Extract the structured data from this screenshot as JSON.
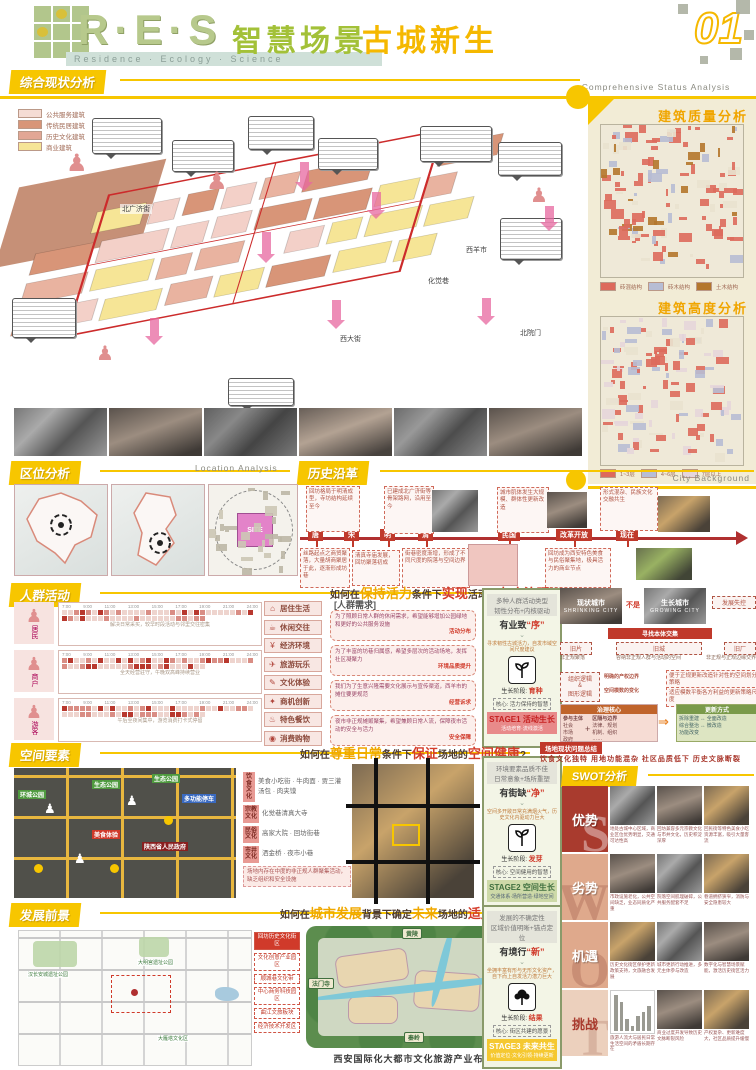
{
  "palette": {
    "accent_yellow": "#f7c600",
    "accent_orange": "#f0a500",
    "brand_green": "#a3c138",
    "deep_red": "#c0392b",
    "cream": "#f2ecd6",
    "swot_dark": "#a93b2e",
    "swot_peach": "#dfa98c"
  },
  "header": {
    "logo": "R·E·S",
    "logo_sub": "Residence · Ecology · Science",
    "title_green": "智慧场景",
    "title_yellow": "古城新生",
    "page_no": "01",
    "section_en": "Comprehensive Status Analysis"
  },
  "status": {
    "title": "综合现状分析",
    "legend": [
      {
        "label": "公共服务建筑",
        "color": "#f5dcd4"
      },
      {
        "label": "传统民居建筑",
        "color": "#d89578"
      },
      {
        "label": "历史文化建筑",
        "color": "#e2a795"
      },
      {
        "label": "商业建筑",
        "color": "#f6e596"
      }
    ],
    "streets": [
      "北广济街",
      "西羊市",
      "化觉巷",
      "西大街",
      "北院门"
    ]
  },
  "sidebar": {
    "quality_title": "建筑质量分析",
    "quality_legend": [
      {
        "label": "砖混结构",
        "color": "#dd6a5c"
      },
      {
        "label": "砖木结构",
        "color": "#b7bdd4"
      },
      {
        "label": "土木结构",
        "color": "#b4772c"
      }
    ],
    "height_title": "建筑高度分析",
    "height_legend": [
      {
        "label": "1~3层",
        "color": "#dd6a5c"
      },
      {
        "label": "4~6层",
        "color": "#b7bdd4"
      },
      {
        "label": "7层以上",
        "color": "#e5d6da"
      }
    ],
    "footer_en": "City Background"
  },
  "location": {
    "title": "区位分析",
    "title_en": "Location Analysis",
    "site": "SITE"
  },
  "history": {
    "title": "历史沿革",
    "eras": [
      "唐",
      "宋",
      "明",
      "清",
      "民国",
      "改革开放",
      "现在"
    ],
    "top_notes": [
      "回坊格局于明清成型，寺坊结构延续至今",
      "已建成北广济街等骨架路网，沿用至今",
      "城市肌体发生大规模、群体性更新改造",
      "形式混杂、民族文化交融共生"
    ],
    "bottom_notes": [
      "丝路起点之商贸聚落，大量胡商聚居于此，逐渐形成坊巷",
      "清真寺庙发展，回坊聚落初成",
      "街巷密度渐增，形成了不同尺度的院落与空间边界",
      "回坊成为西安特色美食与民俗聚集地，极具活力的商业节点"
    ]
  },
  "crowd": {
    "title": "人群活动",
    "q": [
      "如何在",
      "保持活力",
      "条件下",
      "实现",
      "活动的",
      "有序治理",
      "?"
    ],
    "times": [
      "7:00",
      "9:00",
      "11:00",
      "13:00",
      "15:00",
      "17:00",
      "19:00",
      "21:00",
      "24:00"
    ],
    "groups": [
      {
        "name": "居民",
        "cap": "解决日常采买，较早时段活动与邻里交往密集"
      },
      {
        "name": "商户",
        "cap": "全天经营驻守，午晚双高峰持续营业"
      },
      {
        "name": "游客",
        "cap": "午后至夜间集中，游览消费打卡式停留"
      }
    ],
    "acts": [
      "居住生活",
      "休闲交往",
      "经济环境",
      "旅游玩乐",
      "文化体验",
      "商机创新",
      "特色餐饮",
      "消费购物"
    ],
    "act_icons": [
      "⌂",
      "☕",
      "¥",
      "✈",
      "✎",
      "✦",
      "♨",
      "◉"
    ],
    "needs_title": "[人群需求]",
    "needs": [
      {
        "t": "为了照顾日常人群的休闲需求，希望能够增加公园绿地和更好的公共服务设施",
        "tag": "活动分布"
      },
      {
        "t": "为了丰富的坊巷归属感，希望多层次的活动场地，发挥社区凝聚力",
        "tag": "环境品质提升"
      },
      {
        "t": "我们为了生意兴隆需要文化展示与宣传渠道，西羊市的摊位要更规范",
        "tag": "经营诉求"
      },
      {
        "t": "夜市非正规摊贩聚集，希望兼顾日常人流，保障夜市活动的安全与活力",
        "tag": "安全保障"
      }
    ]
  },
  "stage1": {
    "h1": "多种人群活动类型",
    "h2": "韧性分布+内核驱动",
    "key_main": "有业致",
    "key_quote": "“序”",
    "note": "寻求韧性古城活力，自发市域空间尺度建议",
    "stage_label": "生长阶段:",
    "stage_value": "育种",
    "core": "核心: 活力保持的智慧",
    "tag": "STAGE1",
    "name": "活动生长",
    "sub": "活动培育·流线激活"
  },
  "compare": {
    "left_cn": "现状城市",
    "left_en": "SHRINKING CITY",
    "not": "不是",
    "right_cn": "生长城市",
    "right_en": "GROWING CITY",
    "fail": "发展失控",
    "tag": "寻找本体交集",
    "tree": [
      {
        "k": "旧片",
        "v": "非正规聚落"
      },
      {
        "k": "旧城",
        "v": "容纳非正规人群与活动的空间"
      },
      {
        "k": "旧厂",
        "v": "非正规与正规边缘交界"
      }
    ],
    "logic": "组织逻辑\n&\n图形逻辑",
    "r1": "明确的产权边界",
    "r2": "空间模数的变化",
    "n1": "便于正规更新改造针对性的空间划分策略",
    "n2": "适应模数平衡各方利益的更新策略尺度",
    "gov_title": "治理核心",
    "gov_a": "参与主体",
    "gov_a_items": "社会\n市场\n政府",
    "plus": "+",
    "gov_b": "区隔与边界",
    "gov_b_items": "法律、规划\n机制、组织\n……",
    "renew_title": "更新方式",
    "renew_rows": [
      "拆除重建 ↔ 全面改造",
      "综合整治 ↔ 微改造",
      "功能改变"
    ]
  },
  "space": {
    "title": "空间要素",
    "q": [
      "如何在",
      "尊重日常",
      "条件下",
      "保证",
      "场地的",
      "空间健康",
      "?"
    ],
    "map_labels": [
      {
        "t": "环城公园",
        "c": "g"
      },
      {
        "t": "生态公园",
        "c": "g"
      },
      {
        "t": "生态公园",
        "c": "g"
      },
      {
        "t": "美食体验",
        "c": "r"
      },
      {
        "t": "陕西省人民政府",
        "c": "d"
      },
      {
        "t": "多功能停车",
        "c": "b"
      }
    ],
    "cultures": [
      {
        "cat": "饮食文化",
        "items": "美食小吃街 · 牛肉面 · 贾三灌汤包 · 肉夹馍"
      },
      {
        "cat": "宗教文化",
        "items": "化觉巷清真大寺"
      },
      {
        "cat": "民俗文化",
        "items": "高家大院 · 回坊街巷"
      },
      {
        "cat": "市井文化",
        "items": "洒金桥 · 夜市小巷"
      }
    ],
    "note": "场地内存在中度的非正规人群聚集活动，缺乏组织和安全设施"
  },
  "stage2": {
    "h1": "环境要素品质不佳",
    "h2": "日常意象+场所重塑",
    "key_main": "有街缺",
    "key_quote": "“净”",
    "note": "空间多开敞日常充满烟火气，历史文化内驱动力巨大",
    "stage_label": "生长阶段:",
    "stage_value": "发芽",
    "core": "核心: 空间健用的智慧",
    "tag": "STAGE2",
    "name": "空间生长",
    "sub": "交通体系·场所营造·绿地空间"
  },
  "swot": {
    "badge": "场地现状问题总结",
    "summary": "饮食文化独特 用地功能混杂 社区品质低下 历史文脉断裂",
    "title": "SWOT分析",
    "rows": [
      {
        "letter": "S",
        "label": "优势",
        "caps": [
          "地处古城中心区域，商业区位优势明显，交通可达性高",
          "回坊兼容多元宗教文化与市井文化，历史积淀深厚",
          "回民街等特色美食小吃资源丰富，吸引大量客流"
        ]
      },
      {
        "letter": "W",
        "label": "劣势",
        "caps": [
          "市政设施老化，公共空间缺乏，业态同质化严重",
          "院落空间肌理破碎，公共服务配套不足",
          "巷道拥挤狭窄，消防与安全隐患较大"
        ]
      },
      {
        "letter": "O",
        "label": "机遇",
        "caps": [
          "历史文化街区保护更新政策支持，文旅融合发展",
          "城市更新行动推进，多元主体参与改造",
          "数字化与智慧场景赋能，激活历史街区活力"
        ]
      },
      {
        "letter": "T",
        "label": "挑战",
        "caps": [
          "旅游人流大与居民日常生活空间的矛盾长期存在",
          "商业过度开发导致历史文脉断裂风险",
          "产权复杂、更新难度大，社区品质提升缓慢"
        ]
      }
    ],
    "chart": {
      "type": "bar",
      "values": [
        95,
        75,
        30,
        12,
        38,
        50,
        66
      ]
    }
  },
  "prospect": {
    "title": "发展前景",
    "q": [
      "如何在",
      "城市发展",
      "背景下确定",
      "未来",
      "场地的",
      "适用定位",
      "?"
    ],
    "plan_labels": [
      "回坊历史文化街区",
      "文化创意产业园区",
      "顺城巷文化带",
      "中心商务科技园区",
      "曲江文旅板块",
      "经济技术开发区"
    ],
    "map_names": [
      "汉长安城遗址公园",
      "大明宫遗址公园",
      "大雁塔文化区"
    ],
    "corners": [
      "黄陵",
      "法门寺",
      "华山",
      "秦岭"
    ],
    "caption": "西安国际化大都市文化旅游产业布局"
  },
  "stage3": {
    "h1": "发展的不确定性",
    "h2": "区域价值明晰+锚点定位",
    "key_main": "有境行",
    "key_quote": "“新”",
    "note": "坐拥丰富有形与无形文化资产，自下而上自发活力潜力巨大",
    "stage_label": "生长阶段:",
    "stage_value": "结果",
    "core": "核心: 街区共建的愿景",
    "tag": "STAGE3",
    "name": "未来共生",
    "sub": "价值定位·文化引领·持续更新"
  }
}
